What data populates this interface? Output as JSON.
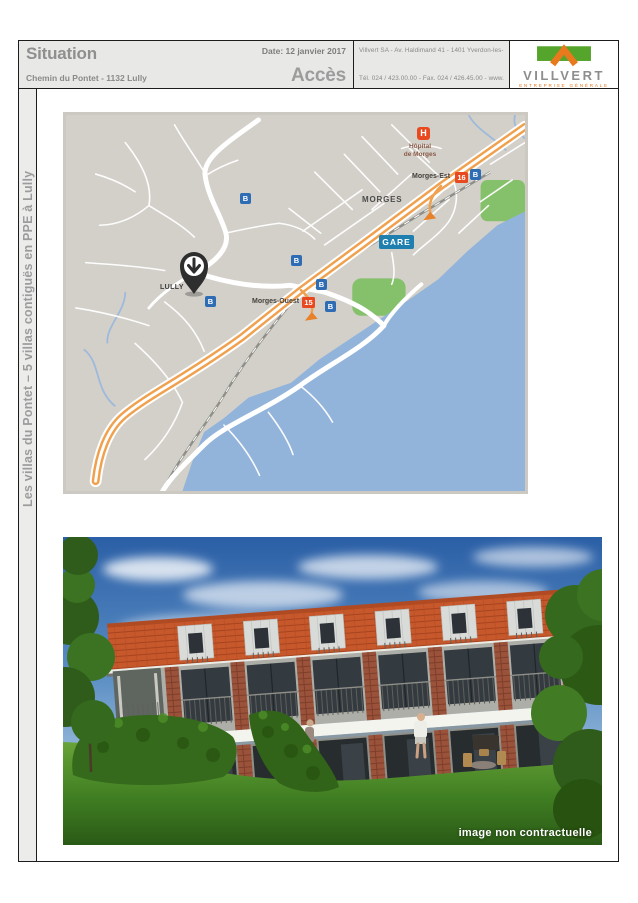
{
  "header": {
    "title": "Situation",
    "subtitle": "Chemin du Pontet - 1132 Lully",
    "date": "Date: 12 janvier 2017",
    "acces": "Accès"
  },
  "company": {
    "line1": "Villvert SA  -  Av. Haldimand 41  -  1401 Yverdon-les-Bains",
    "line2": "Tél. 024 / 423.00.00 - Fax. 024 / 426.45.00 - www.villvert.ch"
  },
  "logo": {
    "name": "VILLVERT",
    "tagline": "ENTREPRISE GÉNÉRALE",
    "green": "#55a42b",
    "orange": "#e8791c"
  },
  "sidebar": {
    "vertical_title": "Les villas du Pontet – 5 villas contiguës en PPE à Lully"
  },
  "map": {
    "labels": {
      "city": "MORGES",
      "village": "LULLY",
      "station_badge": "GARE",
      "hospital_line1": "Hôpital",
      "hospital_line2": "de Morges",
      "hospital_badge": "H",
      "exit_east": "Morges-Est",
      "exit_east_badge": "16",
      "exit_west": "Morges-Ouest",
      "exit_west_badge": "15",
      "bus_badge": "B"
    },
    "colors": {
      "background": "#d3d0ca",
      "water": "#92b4da",
      "park": "#85c16b",
      "road": "#ffffff",
      "highway": "#f0a14f",
      "railway": "#9a9a94",
      "exit_badge": "#e8491f",
      "bus_badge": "#2e6db4",
      "station_badge": "#1f7fae",
      "pin": "#2e2e2e"
    }
  },
  "render": {
    "disclaimer": "image non contractuelle",
    "colors": {
      "sky_top": "#2b5fa6",
      "roof": "#c6582c",
      "brick": "#9b523a",
      "lawn": "#3f7d22",
      "hedge": "#35691b"
    }
  }
}
